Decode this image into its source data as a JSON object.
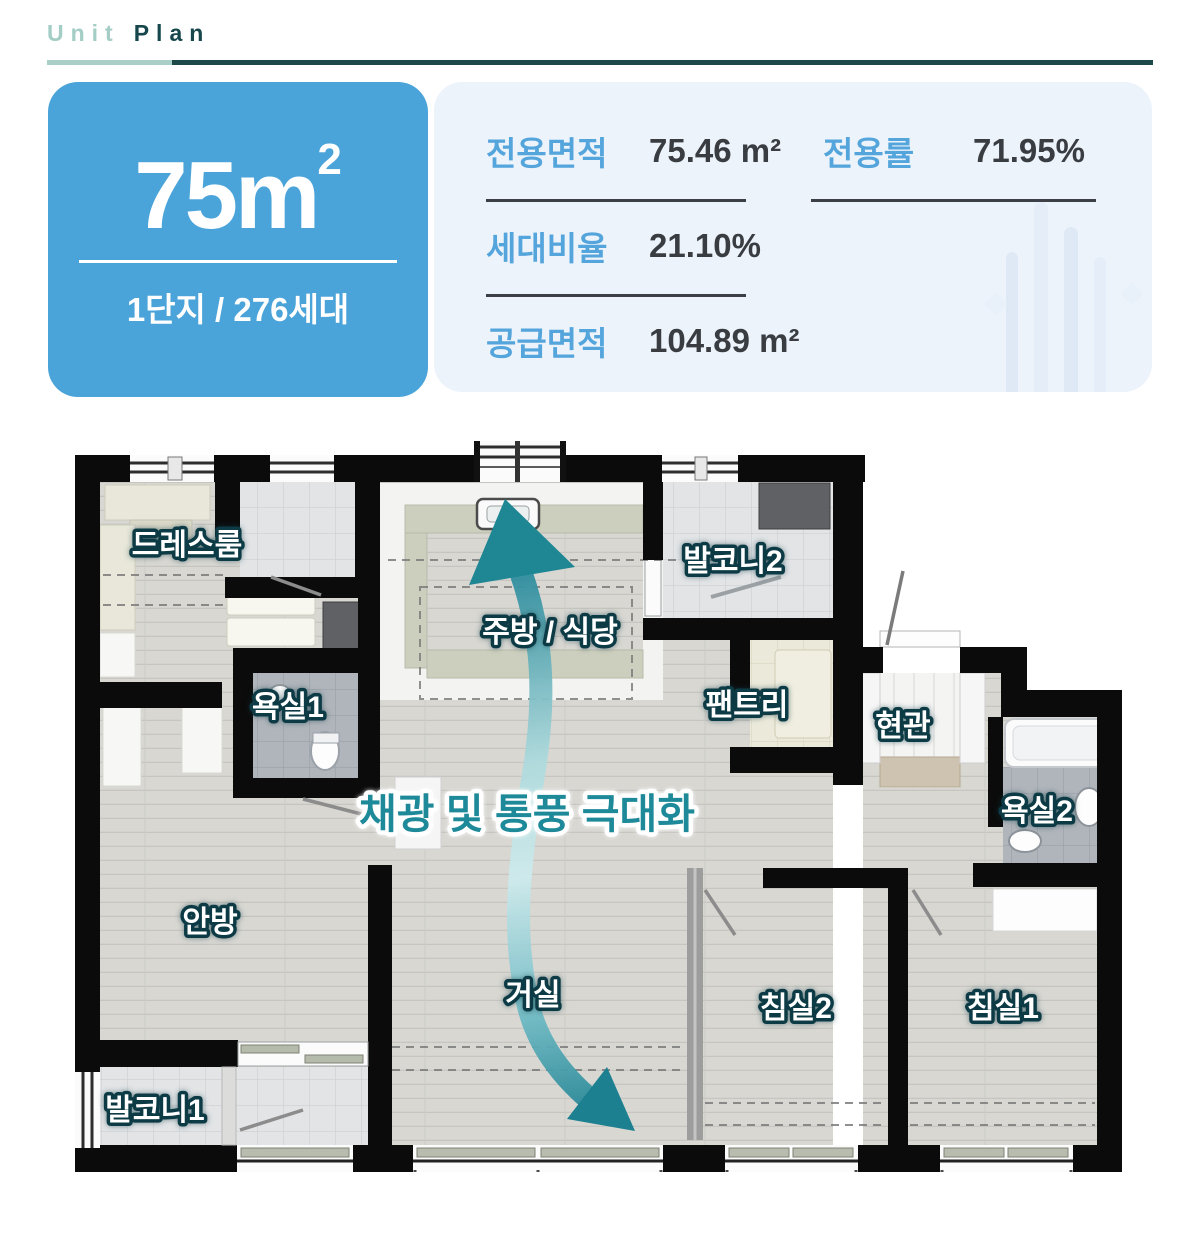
{
  "header": {
    "title_light": "Unit",
    "title_bold": "Plan"
  },
  "summary": {
    "big_area": {
      "number": "75",
      "unit": "m",
      "sup": "2"
    },
    "complex_info": "1단지 / 276세대",
    "stats": [
      {
        "label": "전용면적",
        "value": "75.46 m²"
      },
      {
        "label": "전용률",
        "value": "71.95%"
      },
      {
        "label": "세대비율",
        "value": "21.10%"
      },
      {
        "label": "공급면적",
        "value": "104.89 m²"
      }
    ]
  },
  "floorplan": {
    "annotation": "채광 및 통풍 극대화",
    "rooms": {
      "dressroom": "드레스룸",
      "bath1": "욕실1",
      "kitchen_dining": "주방 / 식당",
      "balcony2": "발코니2",
      "pantry": "팬트리",
      "entrance": "현관",
      "bath2": "욕실2",
      "master_bedroom": "안방",
      "living_room": "거실",
      "bedroom2": "침실2",
      "bedroom1": "침실1",
      "balcony1": "발코니1"
    }
  },
  "colors": {
    "accent_blue": "#4aa3d9",
    "card_bg": "#edf3fb",
    "stat_label_blue": "#55a5dd",
    "stat_value_dark": "#393d42",
    "title_light_teal": "#a3cdc5",
    "title_dark_teal": "#17474c",
    "arrow_teal": "#1e8794",
    "wall_black": "#0b0b0b"
  }
}
